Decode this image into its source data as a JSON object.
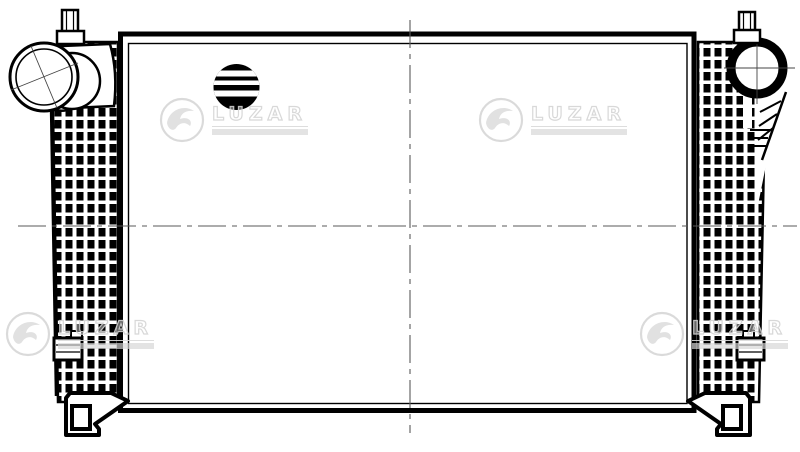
{
  "meta": {
    "kind": "technical line drawing, front view of charge-air cooler (intercooler) with side tanks",
    "background_color": "#ffffff",
    "ink_color": "#000000",
    "centerline_color": "#5a5a5a"
  },
  "watermark": {
    "text": "LUZAR",
    "color": "#d7d7d7",
    "instances": 4,
    "has_tagline_bar": true
  },
  "symbols": {
    "striped_circle": "striped-circle-marker",
    "left_flange": "left-inlet-pipe",
    "right_ring": "right-outlet-port"
  }
}
